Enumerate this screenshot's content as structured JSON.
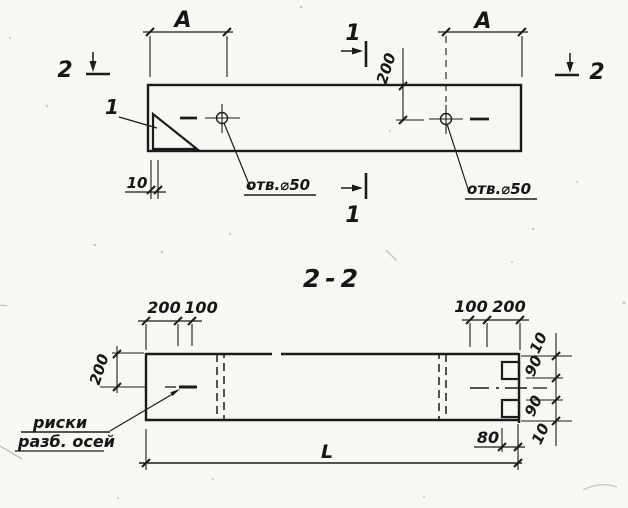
{
  "drawing": {
    "colors": {
      "paper": "#f8f7f3",
      "ink": "#1b1b1b"
    },
    "plan": {
      "marker_2_left": "2",
      "marker_2_right": "2",
      "marker_1_top": "1",
      "marker_1_bottom": "1",
      "dim_a_left": "A",
      "dim_a_right": "A",
      "dim_200": "200",
      "dim_10": "10",
      "detail_ref": "1",
      "hole_note_left": "отв.⌀50",
      "hole_note_right": "отв.⌀50"
    },
    "section": {
      "title": "2-2",
      "dim_left_200": "200",
      "dim_left_100": "100",
      "dim_right_100": "100",
      "dim_right_200": "200",
      "dim_height_200": "200",
      "dim_edge_10_top": "10",
      "dim_notch_90_top": "90",
      "dim_notch_90_bottom": "90",
      "dim_edge_10_bottom": "10",
      "dim_80": "80",
      "dim_length": "L",
      "axis_note_line1": "риски",
      "axis_note_line2": "разб. осей"
    }
  }
}
